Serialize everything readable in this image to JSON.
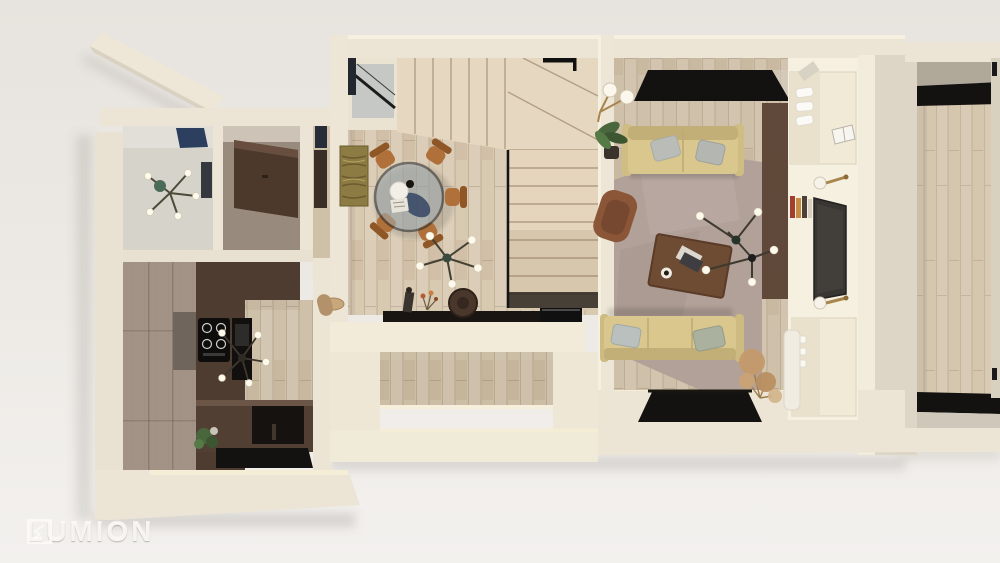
{
  "watermark": {
    "label": "LUMION",
    "logo": "lumion-crystal-icon"
  },
  "scene": {
    "type": "3d-floorplan-top-view-render",
    "rooms": [
      "bedroom-top-left",
      "closet-room",
      "kitchen",
      "dining-area",
      "staircase",
      "living-room",
      "side-room"
    ]
  },
  "palette": {
    "bg_top": "#e7e3de",
    "bg_bottom": "#f3f1ee",
    "wall": "#ece5d5",
    "wall_bright": "#f6f0e0",
    "wall_shade": "#ddd6c7",
    "glow": "#f8efd4",
    "wood_dining": "#d8c9b1",
    "wood_living": "#cfc0a9",
    "wood_right": "#d5c6ae",
    "wood_kitchen": "#cdbfa6",
    "stair": "#e6d8c0",
    "kitchen_dark": "#4e3c31",
    "cabinet": "#9c8c80",
    "counter_dark": "#513f33",
    "window_black": "#141210",
    "room_gray": "#d6d3cb",
    "room_taupe": "#988a7d",
    "furniture_dark": "#4c392b",
    "carpet": "#b2a199",
    "sofa": "#d9c78e",
    "sofa_shade": "#c2ae77",
    "pillow": "#b9bcb7",
    "chair": "#b0703a",
    "armchair": "#8a5637",
    "table": "#6e4b33",
    "tv": "#383633",
    "glass": "#9fadb5",
    "navy": "#2c3f5e",
    "art": "#8d7b44",
    "gold": "#a8854c",
    "plant": "#49663c",
    "pampas": "#c49a6a",
    "white": "#f5f2ea",
    "ledge_black": "#181512"
  }
}
